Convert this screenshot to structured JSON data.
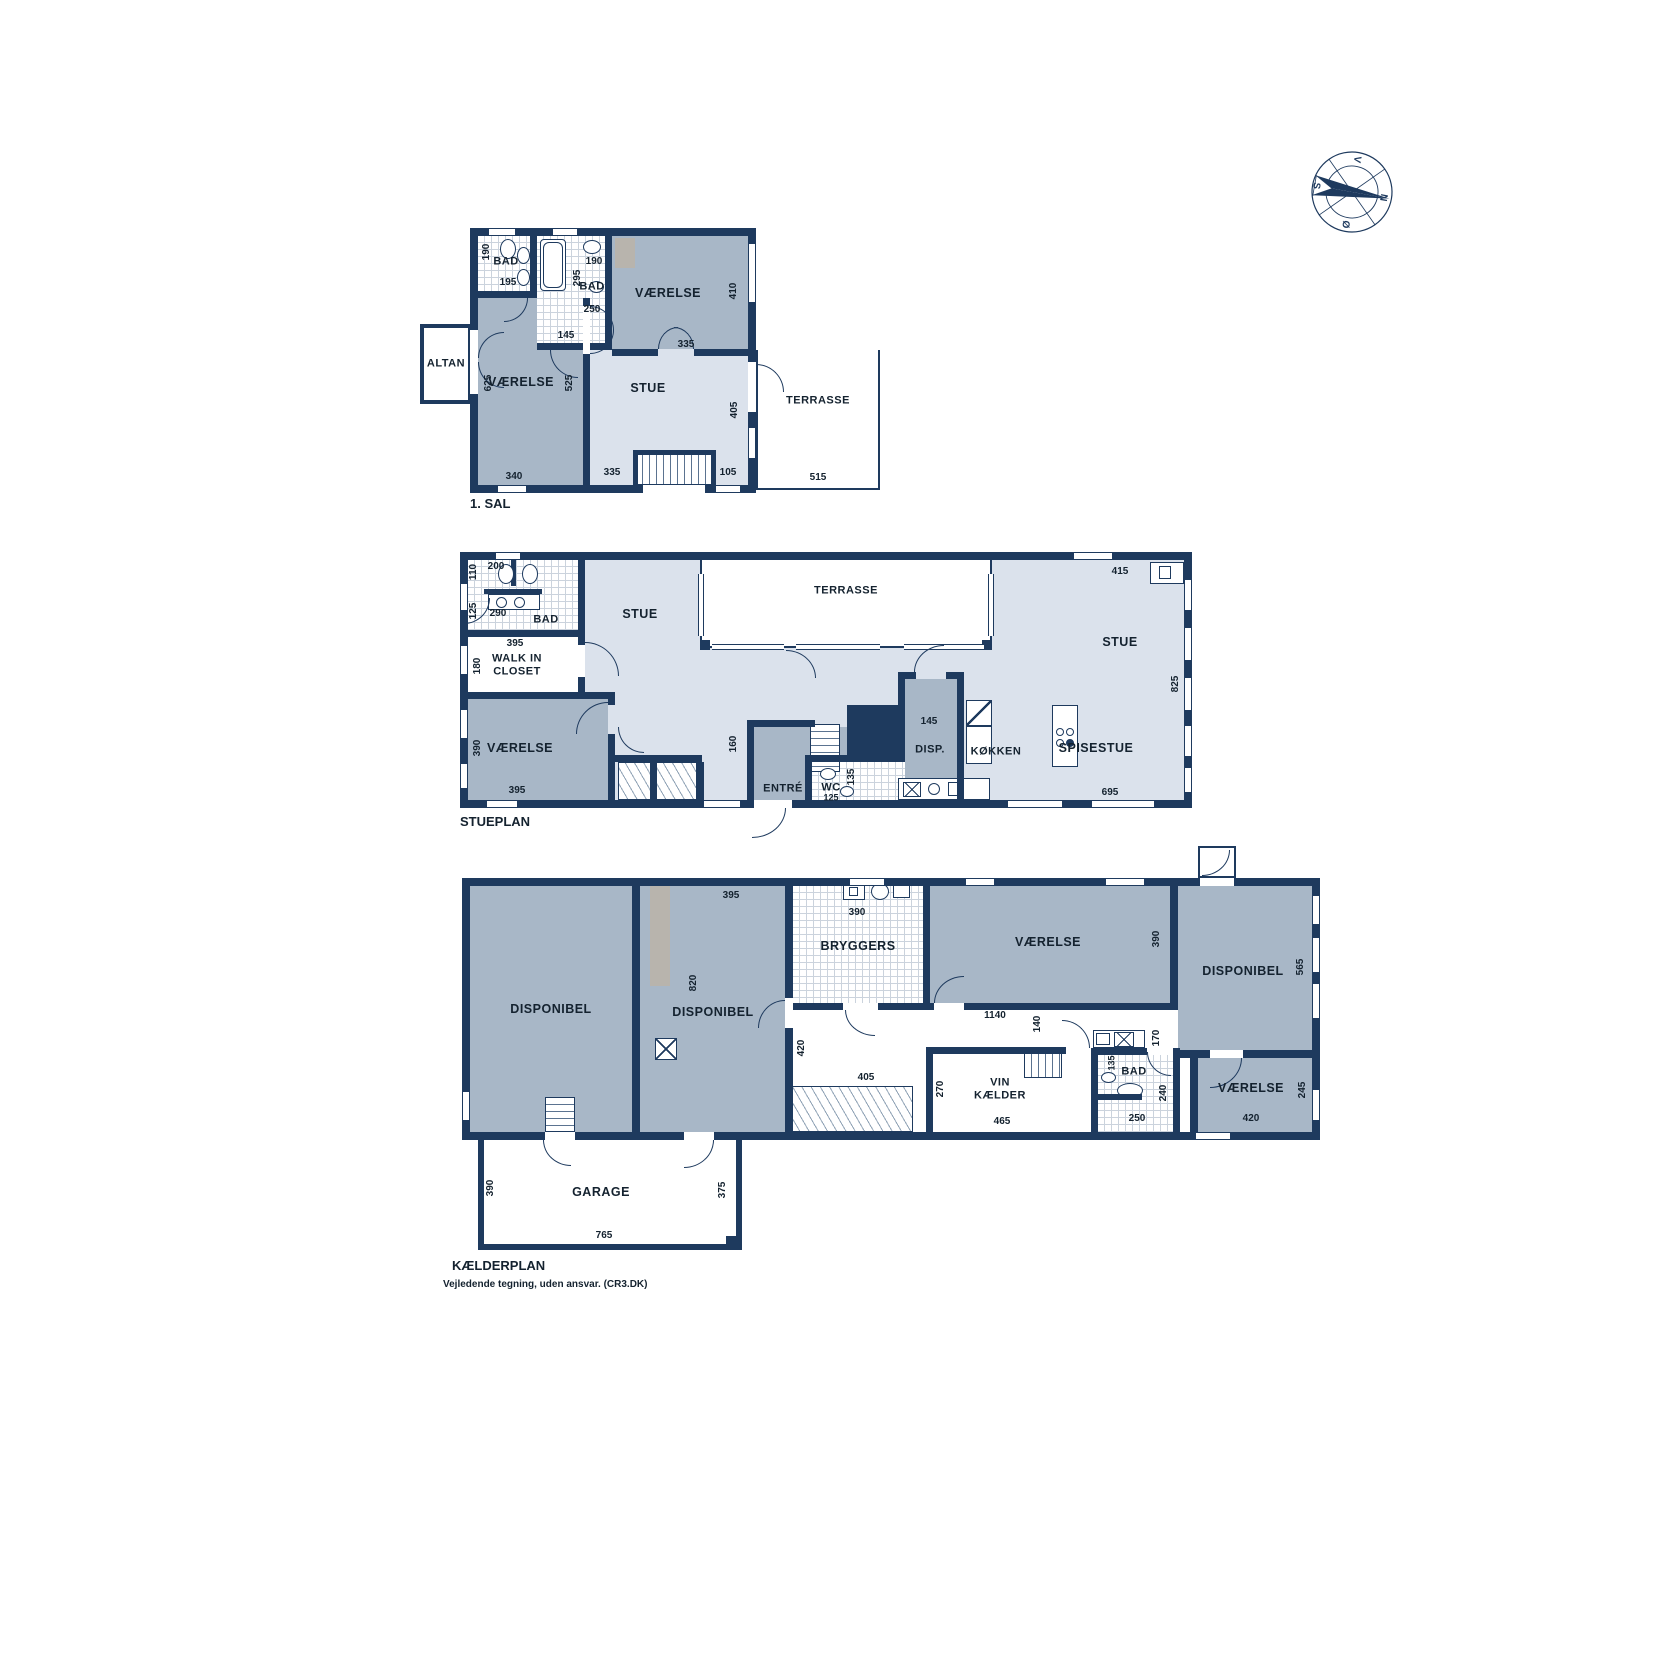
{
  "colors": {
    "wall": "#1e3a5e",
    "room_medium": "#a8b7c7",
    "room_light": "#dbe2ec",
    "outdoor": "#ffffff",
    "gray_closet": "#b8b4ad",
    "text": "#14222f"
  },
  "compass": {
    "n": "N",
    "e": "Ø",
    "s": "S",
    "w": "V"
  },
  "sal1": {
    "title": "1. SAL",
    "rooms": {
      "bad1": "BAD",
      "bad2": "BAD",
      "vaer_tr": "VÆRELSE",
      "vaer_l": "VÆRELSE",
      "stue": "STUE",
      "altan": "ALTAN",
      "terrasse": "TERRASSE"
    },
    "dims": {
      "d190a": "190",
      "d195": "195",
      "d190b": "190",
      "d295": "295",
      "d250": "250",
      "d145": "145",
      "d410": "410",
      "d335a": "335",
      "d625": "625",
      "d525": "525",
      "d340": "340",
      "d405": "405",
      "d335b": "335",
      "d105": "105",
      "d515": "515"
    }
  },
  "stueplan": {
    "title": "STUEPLAN",
    "rooms": {
      "bad": "BAD",
      "wic1": "WALK IN",
      "wic2": "CLOSET",
      "vaer": "VÆRELSE",
      "stue": "STUE",
      "terrasse": "TERRASSE",
      "stue_r": "STUE",
      "spisestue": "SPISESTUE",
      "kokken": "KØKKEN",
      "disp": "DISP.",
      "entre": "ENTRÉ",
      "wc": "WC"
    },
    "dims": {
      "d110": "110",
      "d200": "200",
      "d125": "125",
      "d290": "290",
      "d395a": "395",
      "d180": "180",
      "d390": "390",
      "d395b": "395",
      "d160": "160",
      "d415": "415",
      "d825": "825",
      "d695": "695",
      "d145": "145",
      "d135": "135",
      "d125wc": "125"
    }
  },
  "kaelder": {
    "title": "KÆLDERPLAN",
    "rooms": {
      "disp_l": "DISPONIBEL",
      "disp_2": "DISPONIBEL",
      "bryggers": "BRYGGERS",
      "vaer_m": "VÆRELSE",
      "vin1": "VIN",
      "vin2": "KÆLDER",
      "bad": "BAD",
      "disp_r": "DISPONIBEL",
      "vaer_br": "VÆRELSE",
      "garage": "GARAGE"
    },
    "dims": {
      "d395": "395",
      "d820": "820",
      "d390a": "390",
      "d390b": "390",
      "d1140": "1140",
      "d420a": "420",
      "d405": "405",
      "d140": "140",
      "d170": "170",
      "d270": "270",
      "d465": "465",
      "d135": "135",
      "d240": "240",
      "d250": "250",
      "d565": "565",
      "d420b": "420",
      "d245": "245",
      "d390c": "390",
      "d375": "375",
      "d765": "765"
    }
  },
  "footer": {
    "disclaimer": "Vejledende tegning, uden ansvar. (CR3.DK)"
  }
}
